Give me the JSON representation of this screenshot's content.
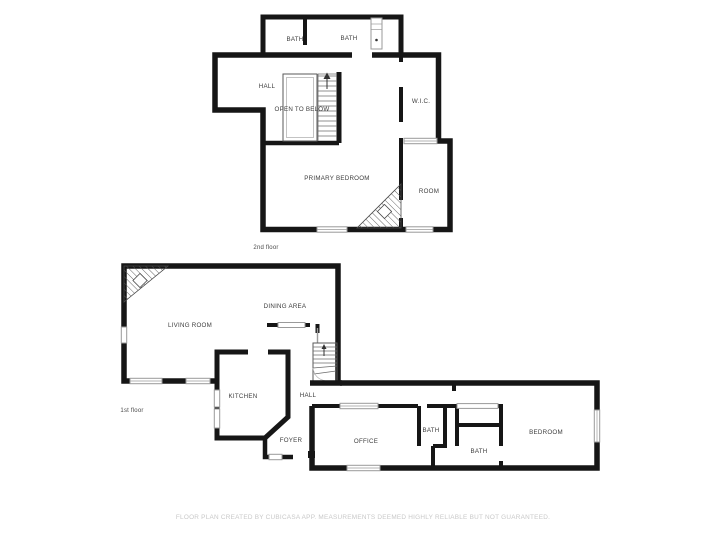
{
  "floor2": {
    "caption": "2nd floor",
    "rooms": {
      "bath1": "BATH",
      "bath2": "BATH",
      "hall": "HALL",
      "open_to_below": "OPEN TO BELOW",
      "wic": "W.I.C.",
      "primary_bedroom": "PRIMARY BEDROOM",
      "room": "ROOM"
    }
  },
  "floor1": {
    "caption": "1st floor",
    "rooms": {
      "living_room": "LIVING ROOM",
      "dining_area": "DINING AREA",
      "kitchen": "KITCHEN",
      "hall": "HALL",
      "foyer": "FOYER",
      "office": "OFFICE",
      "bath_upper": "BATH",
      "bath_lower": "BATH",
      "bedroom": "BEDROOM"
    }
  },
  "footer": {
    "disclaimer": "FLOOR PLAN CREATED BY CUBICASA APP. MEASUREMENTS DEEMED HIGHLY RELIABLE BUT NOT GUARANTEED."
  },
  "colors": {
    "wall": "#161616",
    "window": "#9a9a9a",
    "label": "#3d3d3d",
    "caption": "#4a4a4a",
    "disclaimer": "#c8c8c8",
    "background": "#ffffff"
  }
}
